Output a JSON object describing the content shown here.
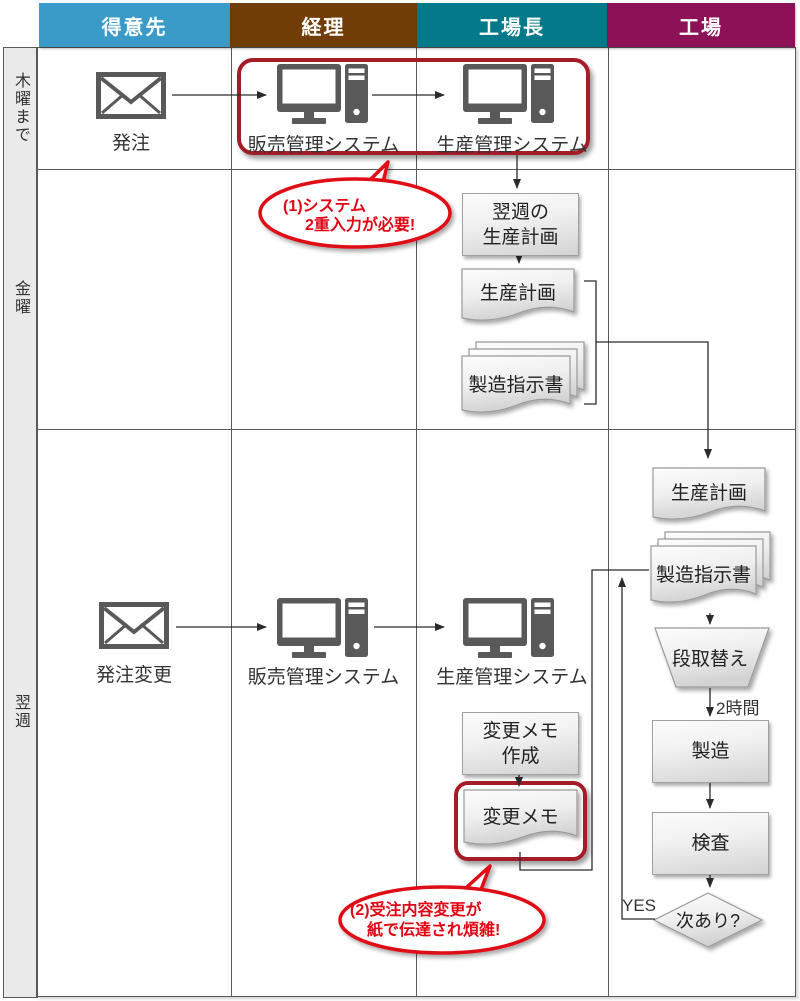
{
  "header": {
    "lanes": [
      {
        "label": "得意先",
        "color": "#3A9AC8"
      },
      {
        "label": "経理",
        "color": "#6F3D05"
      },
      {
        "label": "工場長",
        "color": "#04798A"
      },
      {
        "label": "工場",
        "color": "#8C1157"
      }
    ]
  },
  "row_labels": {
    "thursday": "木曜まで",
    "friday": "金曜",
    "next_week": "翌週"
  },
  "thursday_row": {
    "order_label": "発注",
    "sales_system": "販売管理システム",
    "production_system": "生産管理システム"
  },
  "callout1": {
    "line1": "(1)システム",
    "line2": "2重入力が必要!"
  },
  "friday_row": {
    "weekly_plan_line1": "翌週の",
    "weekly_plan_line2": "生産計画",
    "production_plan_doc": "生産計画",
    "instruction_doc": "製造指示書"
  },
  "next_week_row": {
    "order_change_label": "発注変更",
    "sales_system": "販売管理システム",
    "production_system": "生産管理システム",
    "memo_create_line1": "変更メモ",
    "memo_create_line2": "作成",
    "memo_doc": "変更メモ"
  },
  "callout2": {
    "line1": "(2)受注内容変更が",
    "line2": "紙で伝達され煩雑!"
  },
  "factory_flow": {
    "production_plan_doc": "生産計画",
    "instruction_doc": "製造指示書",
    "setup": "段取替え",
    "duration": "2時間",
    "manufacturing": "製造",
    "inspection": "検査",
    "decision": "次あり?",
    "yes_label": "YES"
  },
  "colors": {
    "accent_red": "#A41C28",
    "callout_red": "#DE0B14",
    "callout_text_red": "#E00613"
  }
}
